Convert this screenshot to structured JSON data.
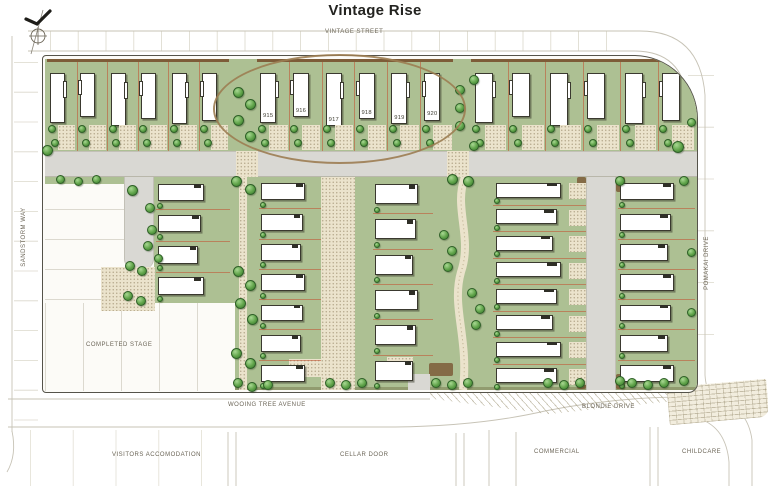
{
  "title": "Vintage Rise",
  "streets": {
    "vintage": "VINTAGE STREET",
    "sandstorm": "SANDSTORM WAY",
    "pomakai": "POMAKAI DRIVE",
    "wooing": "WOOING TREE AVENUE",
    "blondie": "BLONDIE DRIVE"
  },
  "areas": {
    "completed": "COMPLETED STAGE",
    "visitors": "VISITORS ACCOMODATION",
    "cellar": "CELLAR DOOR",
    "commercial": "COMMERCIAL",
    "childcare": "CHILDCARE"
  },
  "lots": {
    "highlighted": [
      "915",
      "916",
      "917",
      "918",
      "919",
      "920"
    ]
  },
  "colors": {
    "lawn": "#adc093",
    "paving": "#ebe3cc",
    "road": "#d9d8d3",
    "road_line": "#c7c3b6",
    "hedge": "#7d5c38",
    "lot_line": "#c1583a",
    "house_outline": "#3a392f",
    "tree_fill": "#5fa349",
    "tree_edge": "#2e5f27",
    "highlight_ellipse": "#9c7d52",
    "text": "#6b6557",
    "title": "#232320"
  }
}
